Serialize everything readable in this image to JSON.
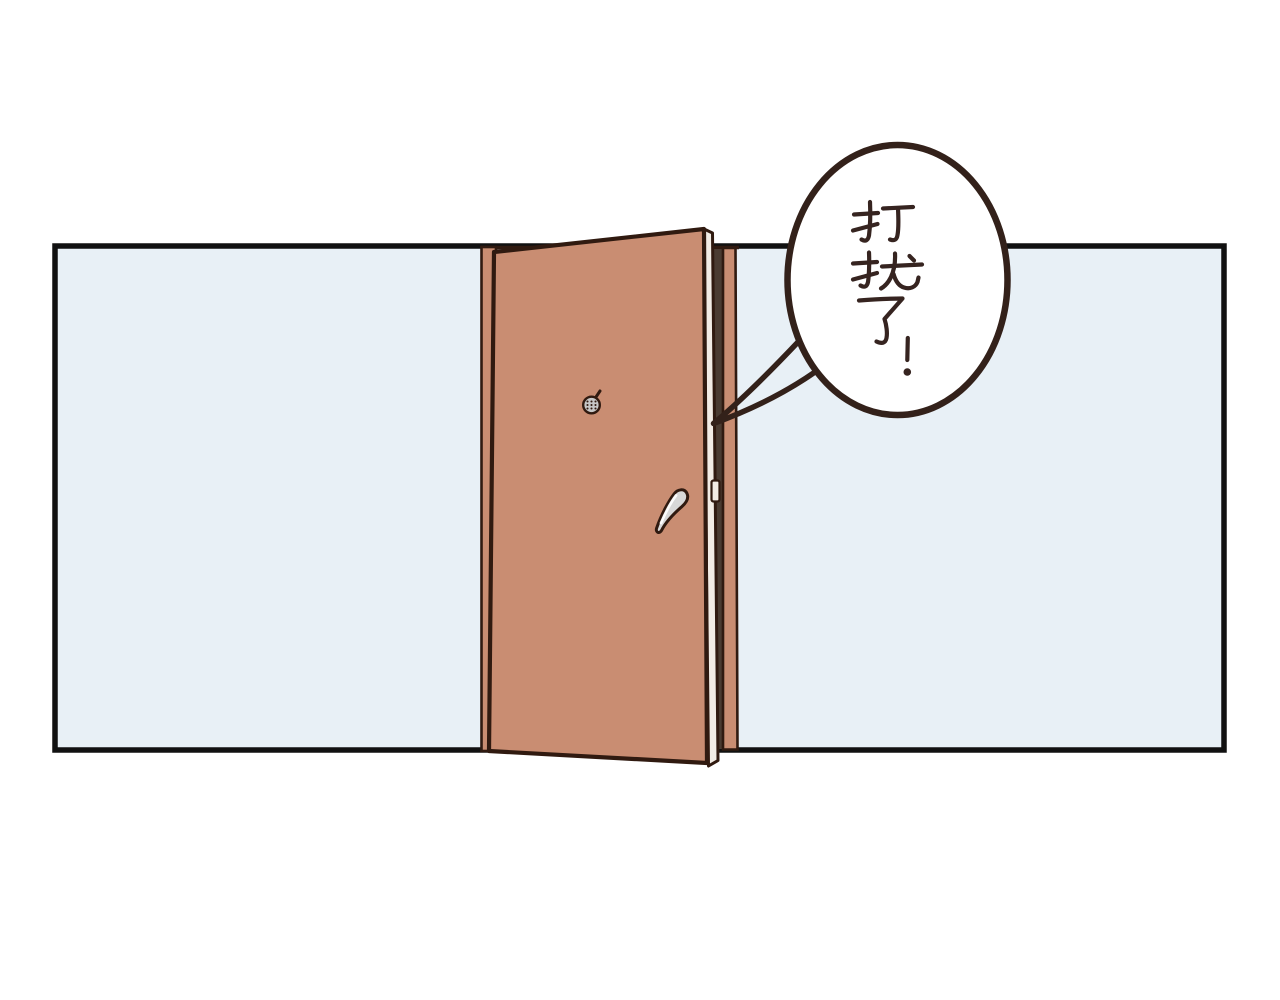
{
  "scene": {
    "description": "Comic panel: a terracotta door stands ajar in a pale blue wall; a speech bubble comes from behind the door",
    "background_color": "#ffffff",
    "ink_color": "#301a10"
  },
  "wall": {
    "fill": "#e8f0f6",
    "border_color": "#111111"
  },
  "door": {
    "panel_color": "#c98d72",
    "frame_color": "#c98d72",
    "edge_face_color": "#f2ece5",
    "gap_shadow_color": "#4a3b31",
    "latch_color": "#f2ece5",
    "handle_color": "#d8d8d8",
    "handle_highlight_color": "#ffffff",
    "peephole_color": "#c6c6c6"
  },
  "speech_bubble": {
    "text": "打扰了!",
    "characters": [
      "打",
      "扰",
      "了",
      "!"
    ],
    "writing_mode": "vertical",
    "fill": "#ffffff",
    "outline_color": "#33211a",
    "text_color": "#362420"
  }
}
